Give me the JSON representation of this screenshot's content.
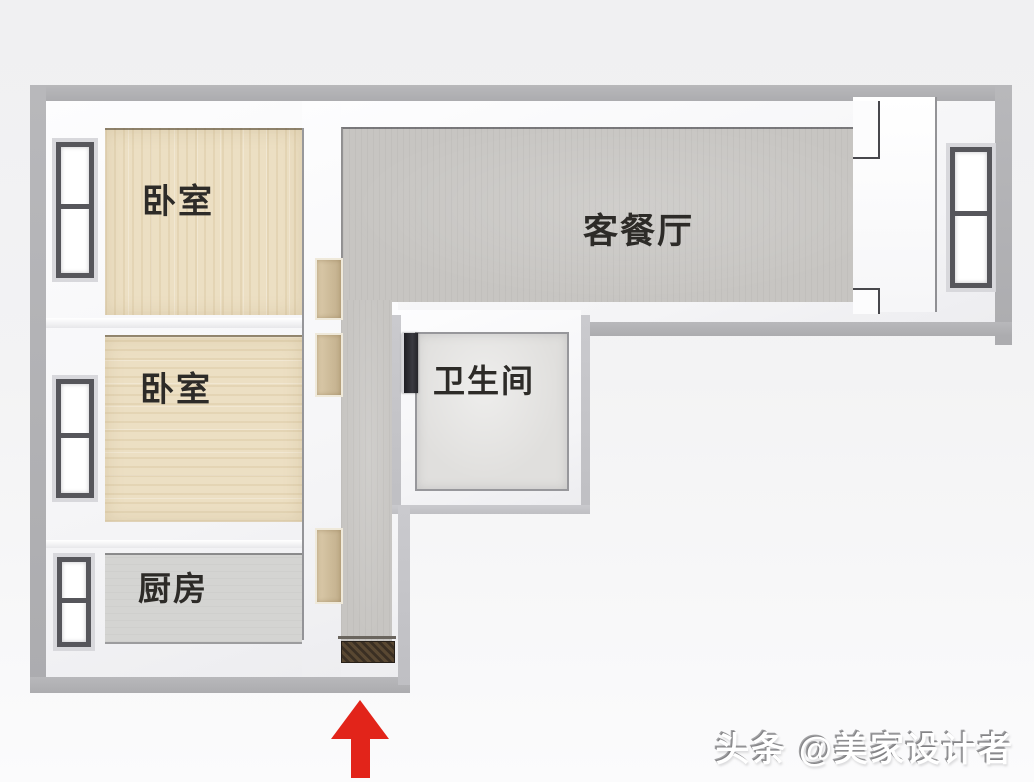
{
  "plan": {
    "kind": "3d-top-view-floor-plan",
    "rooms": [
      {
        "name": "bedroom-1",
        "label": "卧室",
        "floor": "wood"
      },
      {
        "name": "bedroom-2",
        "label": "卧室",
        "floor": "wood"
      },
      {
        "name": "kitchen",
        "label": "厨房",
        "floor": "gray-tile"
      },
      {
        "name": "living-dining",
        "label": "客餐厅",
        "floor": "gray-tile"
      },
      {
        "name": "bathroom",
        "label": "卫生间",
        "floor": "light-tile"
      }
    ],
    "windows": [
      {
        "name": "bedroom-1-window",
        "wall": "left"
      },
      {
        "name": "bedroom-2-window",
        "wall": "left"
      },
      {
        "name": "kitchen-window",
        "wall": "left"
      },
      {
        "name": "living-dining-window",
        "wall": "right"
      }
    ],
    "doors": [
      {
        "name": "bedroom-1-door",
        "material": "wood"
      },
      {
        "name": "bedroom-2-door",
        "material": "wood"
      },
      {
        "name": "kitchen-door",
        "material": "wood"
      },
      {
        "name": "bathroom-door",
        "material": "dark"
      }
    ],
    "entrance": {
      "symbol": "arrow-up",
      "color": "#e2241a"
    }
  },
  "watermark": {
    "text": "头条 @美家设计者",
    "color": "#ffffff"
  },
  "palette": {
    "background": "#f3f3f4",
    "wall_top": "#b1b1b4",
    "wall_face": "#f8f8fa",
    "wood_floor": "#ecdfc3",
    "gray_floor": "#c7c5c2",
    "kitchen_floor": "#d4d4d2",
    "bathroom_floor": "#e0dfdd",
    "window_frame": "#56565b",
    "door_wood": "#cdbb99",
    "bathroom_door": "#26262b",
    "doormat": "#3a2f23",
    "label_text": "#2d2b28",
    "arrow_red": "#e2241a"
  }
}
